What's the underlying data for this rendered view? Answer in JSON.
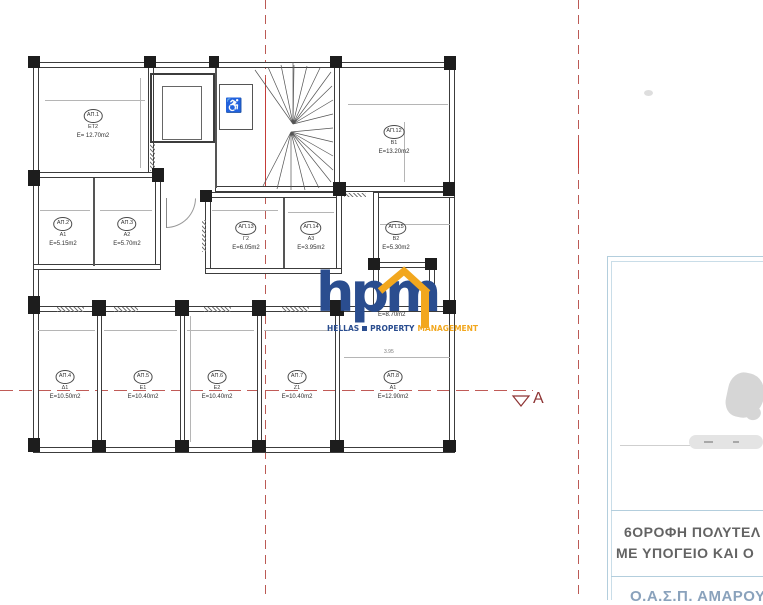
{
  "plan": {
    "rooms": [
      {
        "circle": "ΑΠ.1",
        "code": "ΕΤ2",
        "area": "E= 12.70m2"
      },
      {
        "circle": "ΑΠ.2",
        "code": "Α1",
        "area": "E=5.15m2"
      },
      {
        "circle": "ΑΠ.3",
        "code": "Α2",
        "area": "E=5.70m2"
      },
      {
        "circle": "ΑΠ.13",
        "code": "Γ2",
        "area": "E=6.05m2"
      },
      {
        "circle": "ΑΠ.14",
        "code": "Α3",
        "area": "E=3.95m2"
      },
      {
        "circle": "ΑΠ.15",
        "code": "Β2",
        "area": "E=5.30m2"
      },
      {
        "circle": "ΑΠ.12",
        "code": "Β1",
        "area": "E=13.20m2"
      },
      {
        "circle": "ΑΠ.4",
        "code": "Δ1",
        "area": "E=10.50m2"
      },
      {
        "circle": "ΑΠ.5",
        "code": "Ε1",
        "area": "E=10.40m2"
      },
      {
        "circle": "ΑΠ.6",
        "code": "Ε2",
        "area": "E=10.40m2"
      },
      {
        "circle": "ΑΠ.7",
        "code": "Ζ1",
        "area": "E=10.40m2"
      },
      {
        "circle": "ΑΠ.8",
        "code": "Α1",
        "area": "E=12.90m2"
      }
    ],
    "hidden_room_area": "E=8.70m2",
    "dimension_label": "3.95",
    "section_marker": "A",
    "accessibility_icon": "♿"
  },
  "logo": {
    "text": "hpm",
    "sub": [
      "HELLAS",
      "PROPERTY",
      "MANAGEMENT"
    ]
  },
  "panel": {
    "title_line1": "6ΟΡΟΦΗ  ΠΟΛΥΤΕΛ",
    "title_line2": "ΜΕ  ΥΠΟΓΕΙΟ ΚΑΙ Ο",
    "partial_line": "Ο.Α.Σ.Π.  ΑΜΑΡΟΥΣΙΟΥ"
  },
  "colors": {
    "logo_blue": "#2a4d8f",
    "logo_yellow": "#f2a71e",
    "red_axis_line": "#bb5a55",
    "section_marker_red": "#8e3434",
    "panel_border_blue": "#b3cedd",
    "wall_gray": "#3c3c3c"
  }
}
